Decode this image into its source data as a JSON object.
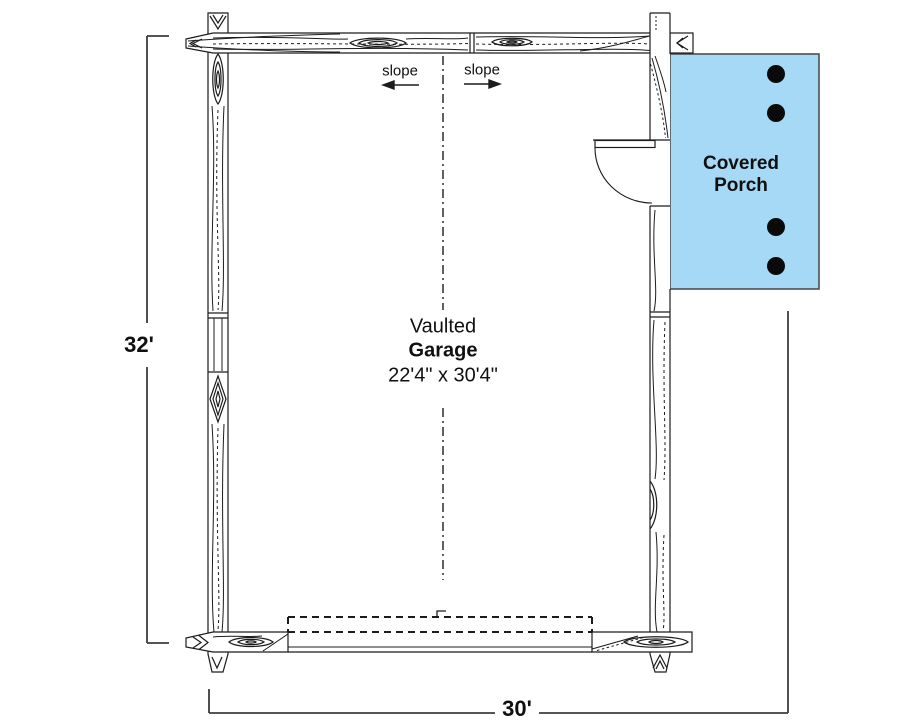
{
  "floor_plan": {
    "room": {
      "name_line1": "Vaulted",
      "name_line2": "Garage",
      "size": "22'4\" x 30'4\""
    },
    "porch": {
      "label_line1": "Covered",
      "label_line2": "Porch",
      "fill_color": "#a6d9f5",
      "post_count": "4"
    },
    "roof": {
      "slope_label_left": "slope",
      "slope_label_right": "slope"
    },
    "dimensions": {
      "left_height": "32'",
      "bottom_width": "30'"
    }
  }
}
